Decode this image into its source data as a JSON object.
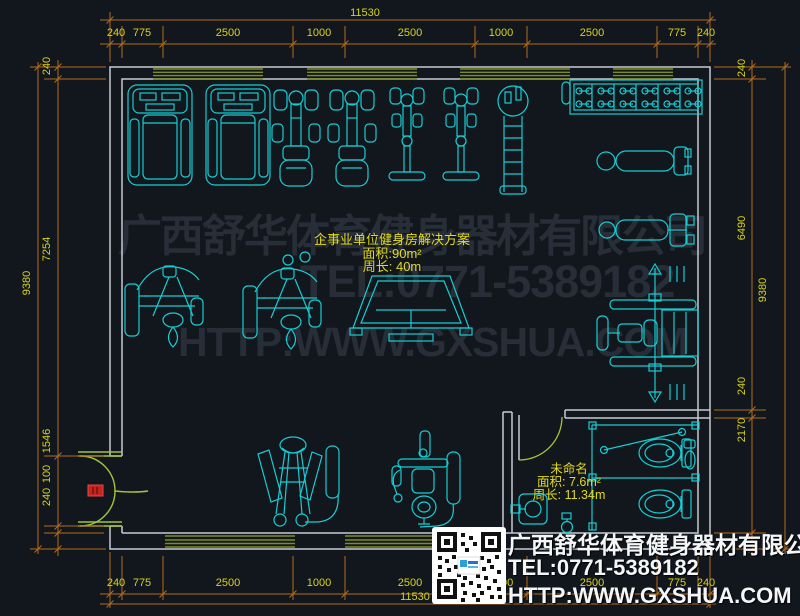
{
  "watermark": {
    "line1": "广西舒华体育健身器材有限公司",
    "line2": "TEL:0771-5389182",
    "line3": "HTTP:WWW.GXSHUA.COM"
  },
  "plan_label": {
    "title": "企事业单位健身房解决方案",
    "area": "面积:90m²",
    "perimeter": "周长: 40m"
  },
  "room_label": {
    "name": "未命名",
    "area": "面积: 7.6m²",
    "perimeter": "周长: 11.34m"
  },
  "contact": {
    "company": "广西舒华体育健身器材有限公司",
    "tel": "TEL:0771-5389182",
    "website": "HTTP:WWW.GXSHUA.COM"
  },
  "dimensions": {
    "top": {
      "total": "11530",
      "segments": [
        "240",
        "775",
        "2500",
        "1000",
        "2500",
        "1000",
        "2500",
        "775",
        "240"
      ]
    },
    "bottom": {
      "total": "11530",
      "segments": [
        "240",
        "775",
        "2500",
        "1000",
        "2500",
        "1000",
        "2500",
        "775",
        "240"
      ]
    },
    "left": {
      "total": "9380",
      "segments": [
        "240",
        "7254",
        "1546",
        "100",
        "240"
      ]
    },
    "right": {
      "total": "9380",
      "segments": [
        "240",
        "6490",
        "240",
        "2170"
      ]
    }
  },
  "colors": {
    "background": "#12171e",
    "wall": "#c7ccd1",
    "equipment": "#17cdd3",
    "window": "#7d8d20",
    "door": "#a2c437",
    "dimension_line": "#b26b1c",
    "dimension_text": "#d8d21d",
    "watermark": "#272e37",
    "highlight_red": "#c8231f",
    "contact_text": "#f4f6f8"
  },
  "equipment_icons": [
    "treadmill",
    "treadmill",
    "recumbent-bike",
    "recumbent-bike",
    "upright-bike",
    "upright-bike",
    "vertical-climber",
    "dumbbell-rack",
    "flat-bench",
    "cable-fly-machine",
    "cable-fly-machine",
    "hack-squat-machine",
    "adjustable-bench",
    "smith-machine",
    "pec-deck-machine",
    "lat-pulldown-machine",
    "toilet",
    "toilet",
    "urinal",
    "sink",
    "floor-drain"
  ]
}
